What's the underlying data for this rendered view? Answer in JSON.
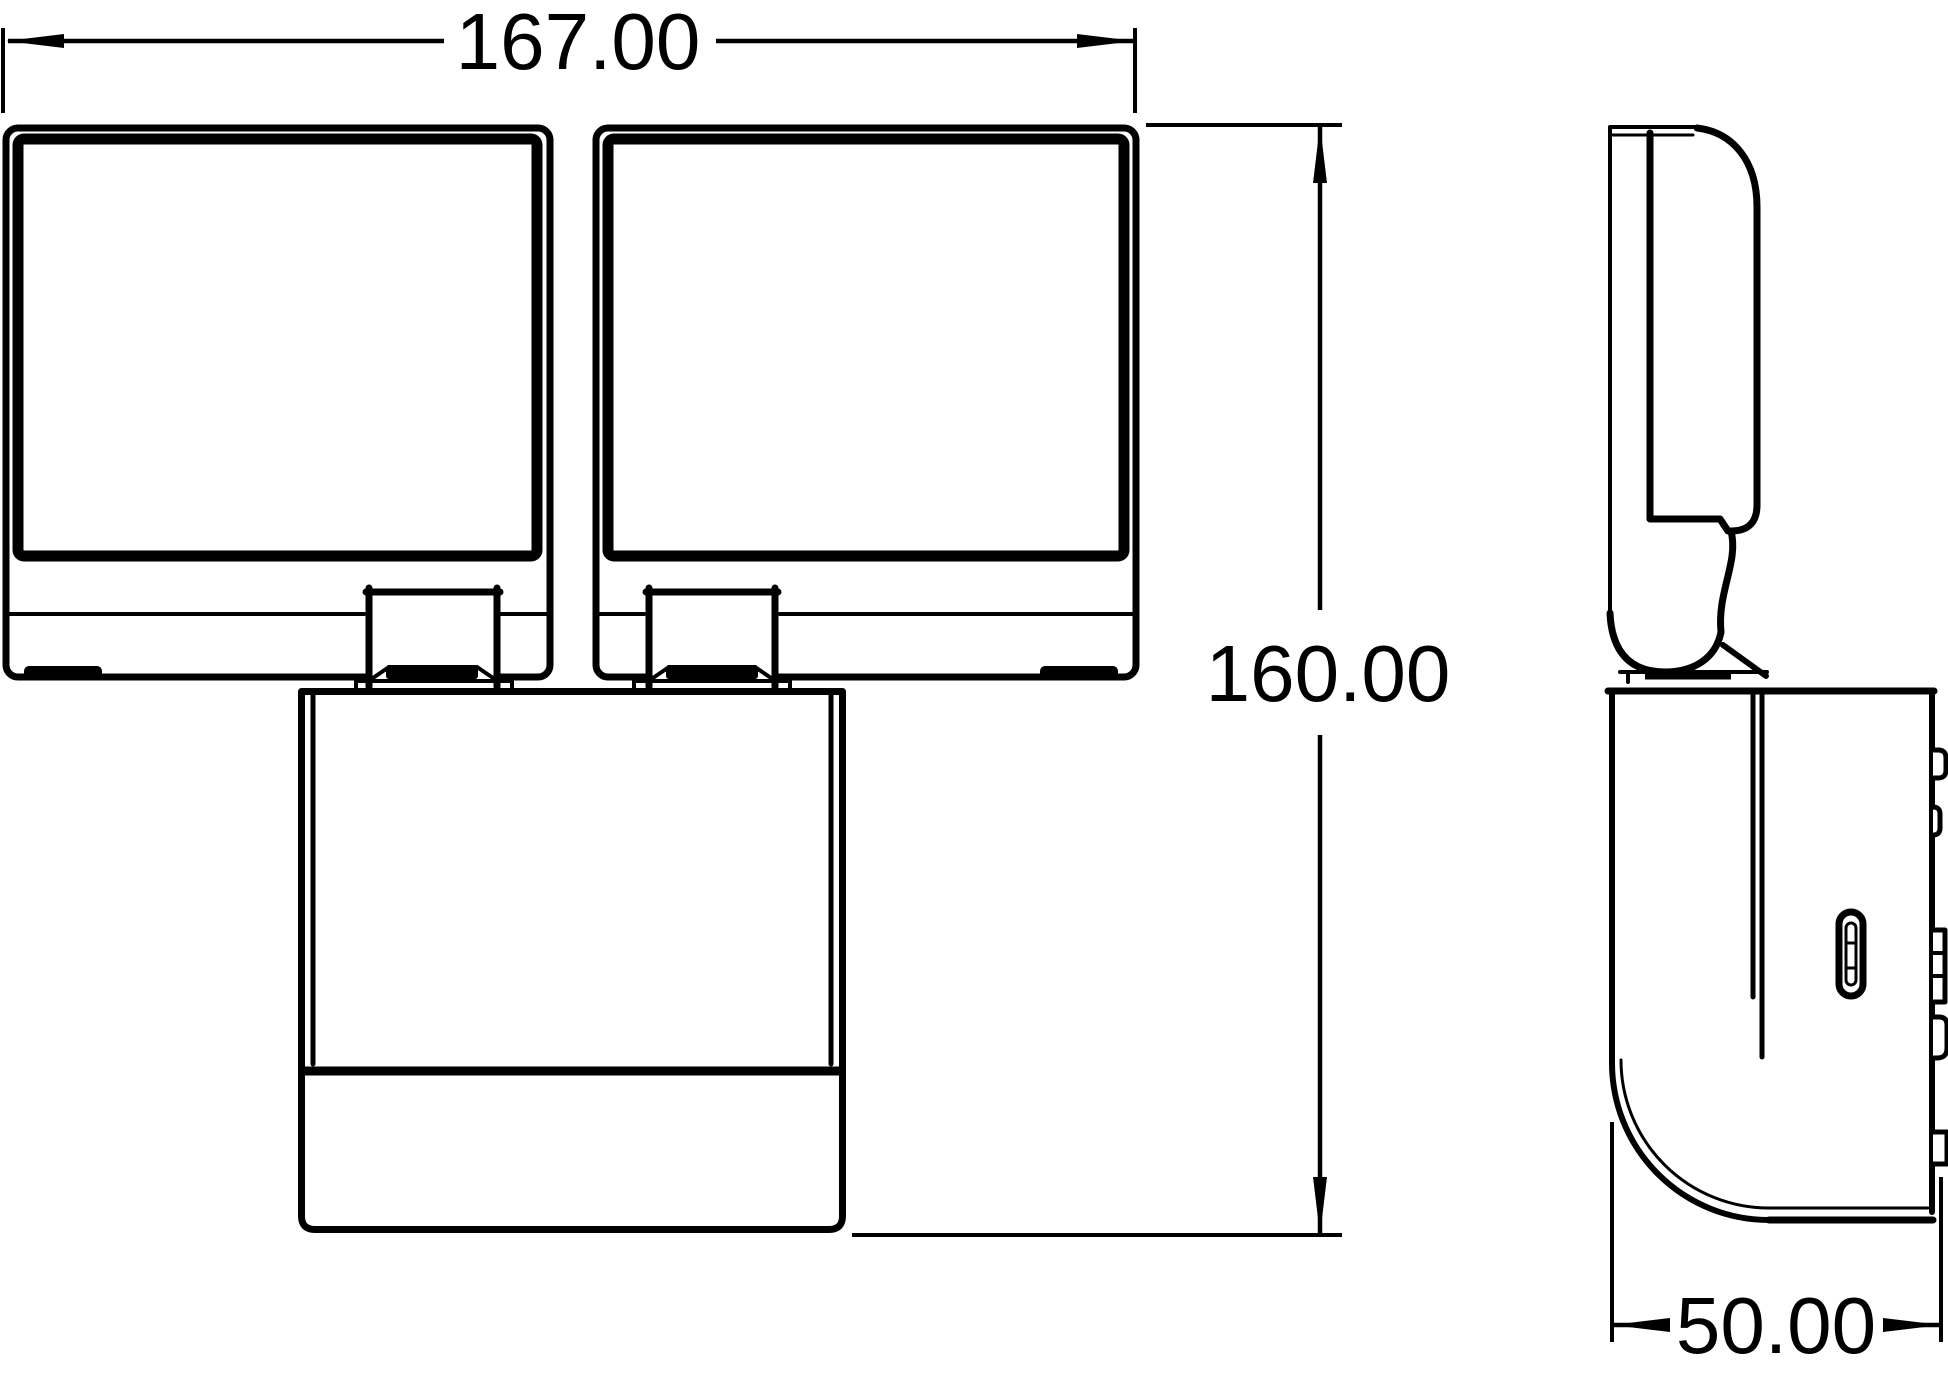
{
  "drawing": {
    "type": "technical dimensional drawing",
    "subject": "twin-head floodlight, front and side views",
    "background_color": "#ffffff",
    "line_color": "#000000"
  },
  "dimensions": {
    "width": "167.00",
    "height": "160.00",
    "depth": "50.00"
  }
}
